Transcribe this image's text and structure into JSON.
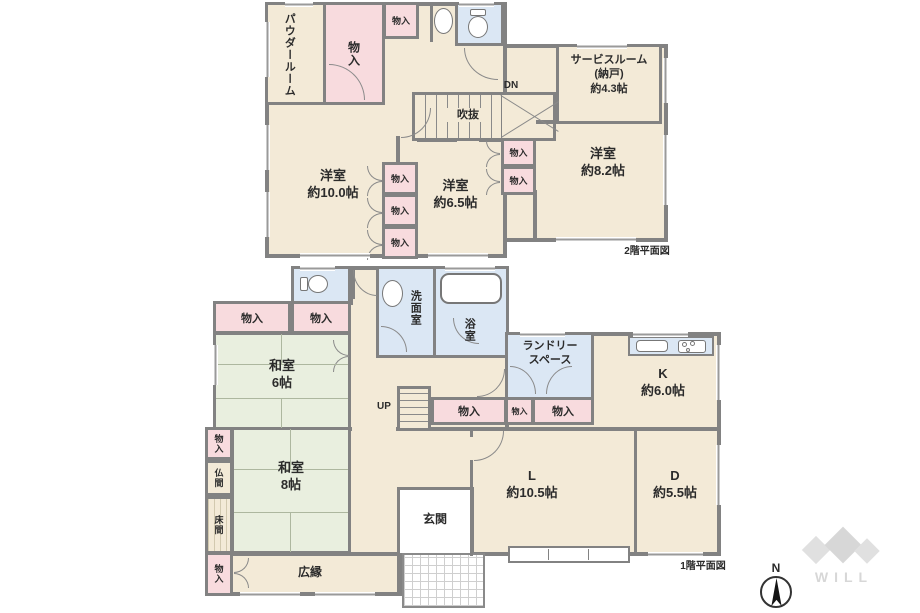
{
  "colors": {
    "floor": "#f3ead7",
    "tatami": "#e9efdf",
    "closet": "#f8dbde",
    "wet": "#dbe7f4",
    "wall": "#828282",
    "text": "#2b2b2b",
    "tatami_line": "#adb79f",
    "logo": "#d7d7d7"
  },
  "floor2": {
    "caption": "2階平面図",
    "powder_room": "パウダールーム",
    "closet": "物入",
    "void_label": "吹抜",
    "down_label": "DN",
    "service_room": {
      "line1": "サービスルーム",
      "line2": "(納戸)",
      "line3": "約4.3帖"
    },
    "west_room_10": {
      "name": "洋室",
      "size": "約10.0帖"
    },
    "west_room_65": {
      "name": "洋室",
      "size": "約6.5帖"
    },
    "west_room_82": {
      "name": "洋室",
      "size": "約8.2帖"
    }
  },
  "floor1": {
    "caption": "1階平面図",
    "closet": "物入",
    "washroom": "洗面室",
    "bathroom": "浴室",
    "laundry": {
      "line1": "ランドリー",
      "line2": "スペース"
    },
    "kitchen": {
      "name": "K",
      "size": "約6.0帖"
    },
    "up_label": "UP",
    "japanese_room_6": {
      "name": "和室",
      "size": "6帖"
    },
    "japanese_room_8": {
      "name": "和室",
      "size": "8帖"
    },
    "altar_room": "仏間",
    "alcove": "床間",
    "veranda": "広縁",
    "entrance": "玄関",
    "living": {
      "name": "L",
      "size": "約10.5帖"
    },
    "dining": {
      "name": "D",
      "size": "約5.5帖"
    }
  },
  "compass": {
    "north": "N"
  },
  "logo": {
    "text": "WILL"
  }
}
